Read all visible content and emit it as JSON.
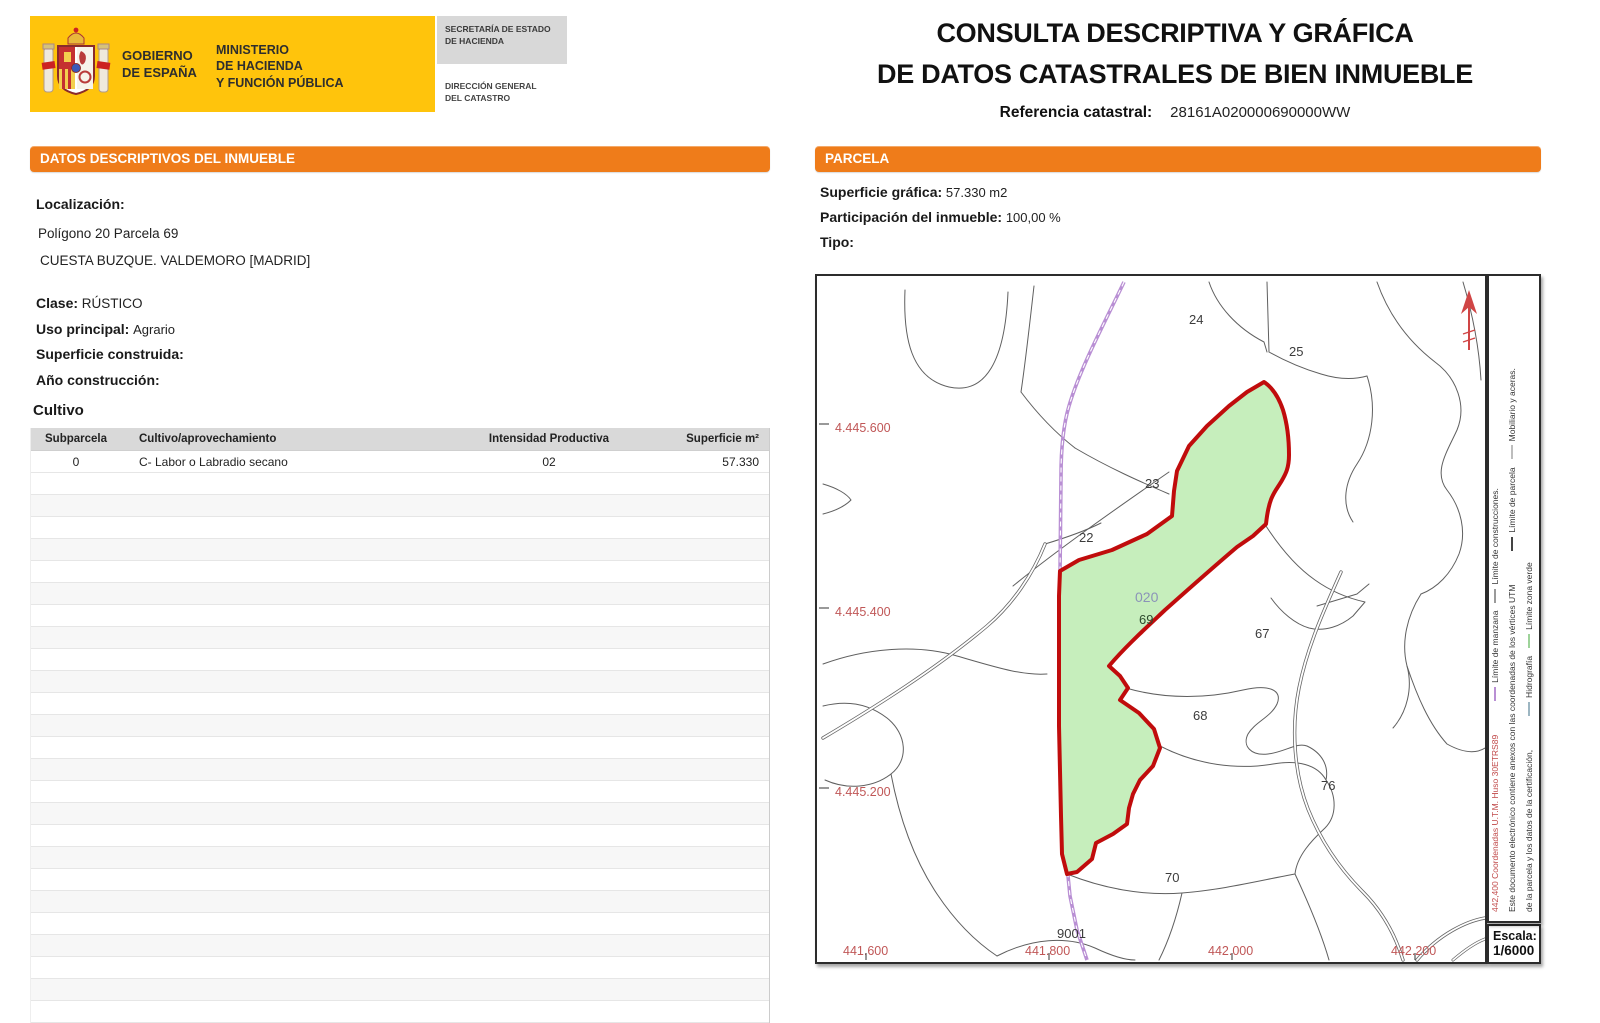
{
  "header": {
    "gobierno_l1": "GOBIERNO",
    "gobierno_l2": "DE ESPAÑA",
    "ministerio_l1": "MINISTERIO",
    "ministerio_l2": "DE HACIENDA",
    "ministerio_l3": "Y FUNCIÓN PÚBLICA",
    "secretaria_l1": "SECRETARÍA DE ESTADO",
    "secretaria_l2": "DE HACIENDA",
    "direccion_l1": "DIRECCIÓN GENERAL",
    "direccion_l2": "DEL CATASTRO",
    "title_l1": "CONSULTA DESCRIPTIVA Y GRÁFICA",
    "title_l2": "DE DATOS CATASTRALES DE BIEN INMUEBLE",
    "ref_label": "Referencia catastral:",
    "ref_value": "28161A020000690000WW"
  },
  "left": {
    "section_title": "DATOS DESCRIPTIVOS DEL INMUEBLE",
    "localizacion_label": "Localización:",
    "localizacion_l1": "Polígono 20 Parcela 69",
    "localizacion_l2": "CUESTA BUZQUE. VALDEMORO [MADRID]",
    "clase_label": "Clase:",
    "clase_value": "RÚSTICO",
    "uso_label": "Uso principal:",
    "uso_value": "Agrario",
    "superficie_label": "Superficie construida:",
    "superficie_value": "",
    "ano_label": "Año construcción:",
    "ano_value": "",
    "cultivo_title": "Cultivo",
    "table": {
      "headers": [
        "Subparcela",
        "Cultivo/aprovechamiento",
        "Intensidad Productiva",
        "Superficie m²"
      ],
      "rows": [
        [
          "0",
          "C- Labor o Labradio secano",
          "02",
          "57.330"
        ]
      ],
      "empty_row_count": 25
    }
  },
  "right": {
    "section_title": "PARCELA",
    "sup_grafica_label": "Superficie gráfica:",
    "sup_grafica_value": "57.330 m2",
    "participacion_label": "Participación del inmueble:",
    "participacion_value": "100,00 %",
    "tipo_label": "Tipo:",
    "map": {
      "parcel_labels": {
        "p24": "24",
        "p25": "25",
        "p23": "23",
        "p22": "22",
        "p020": "020",
        "p69": "69",
        "p67": "67",
        "p68": "68",
        "p76": "76",
        "p70": "70",
        "p9001": "9001"
      },
      "coord_labels": {
        "y1": "4.445.600",
        "y2": "4.445.400",
        "y3": "4.445.200",
        "x1": "441.600",
        "x2": "441.800",
        "x3": "442.000",
        "x4": "442.200"
      },
      "colors": {
        "parcel_fill": "#c6eebc",
        "parcel_border": "#c00c0c",
        "manzana_road": "#b98fd4",
        "coord_text": "#c05757"
      }
    },
    "legend": {
      "line1_red": "442,400 Coordenadas U.T.M. Huso 30ETRS89",
      "line1_a": "Límite de manzana",
      "line1_b": "Límite de construcciones.",
      "line2_note": "Este documento electrónico contiene anexos con las coordenadas de los vértices UTM",
      "line2_a": "Límite de parcela",
      "line2_b": "Mobiliario y aceras.",
      "line3_note": "de la parcela y los datos de la certificación,",
      "line3_a": "Hidrografía",
      "line3_b": "Límite zona verde",
      "escala_label": "Escala:",
      "escala_value": "1/6000"
    }
  }
}
